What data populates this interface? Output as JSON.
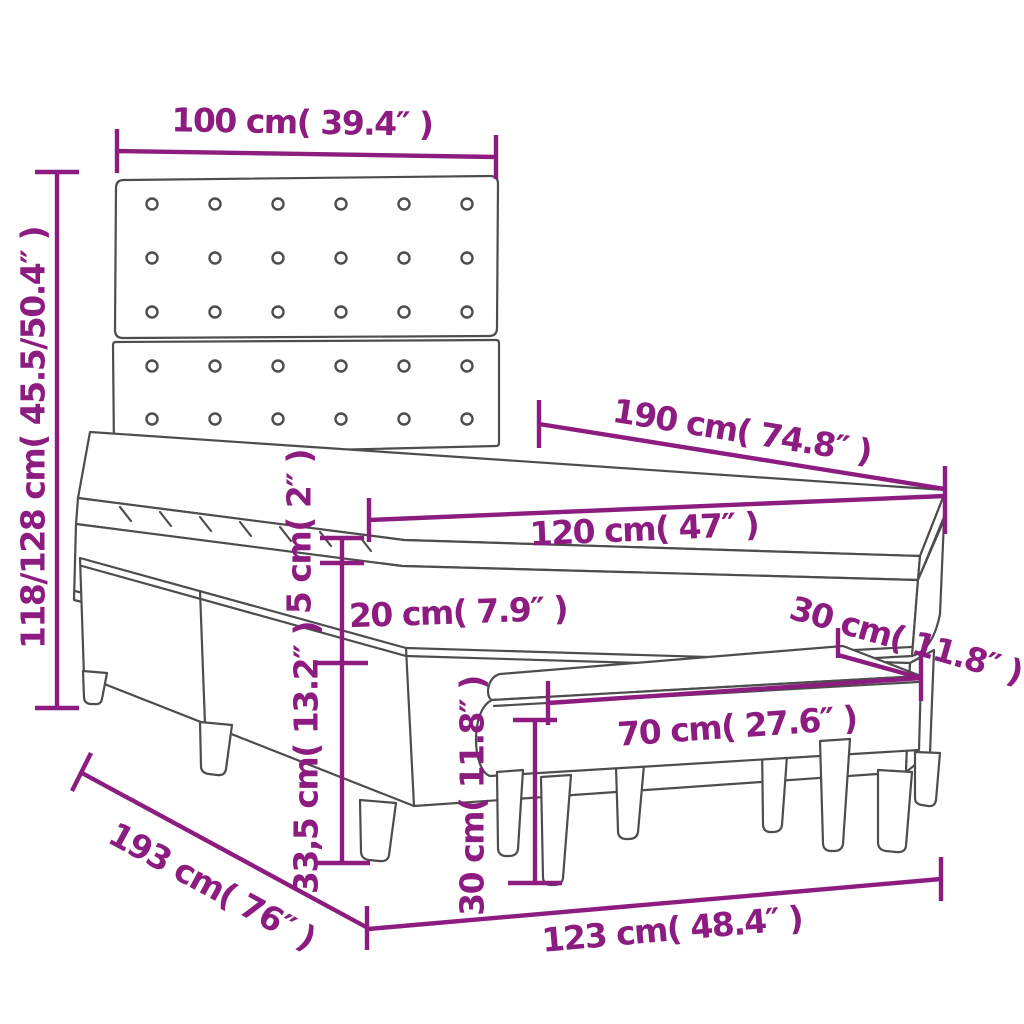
{
  "diagram": {
    "type": "product-dimension-diagram",
    "product": "Box spring bed with tufted headboard, mattress, topper and bench",
    "colors": {
      "dimension_annotation": "#8D1C81",
      "outline": "#4D4D4D",
      "background": "#FFFFFF"
    },
    "labels": {
      "headboard_width": "100 cm( 39.4″ )",
      "bed_height_range": "118/128 cm( 45.5/50.4″ )",
      "mattress_length": "190 cm( 74.8″ )",
      "mattress_width": "120 cm( 47″ )",
      "topper_thickness": "5 cm( 2″ )",
      "mattress_thickness": "20 cm( 7.9″ )",
      "base_height": "33,5 cm( 13.2″ )",
      "bed_length": "193 cm( 76″ )",
      "bed_width": "123 cm( 48.4″ )",
      "bench_length": "70 cm( 27.6″ )",
      "bench_depth": "30 cm( 11.8″ )",
      "bench_height": "30 cm( 11.8″ )"
    }
  }
}
